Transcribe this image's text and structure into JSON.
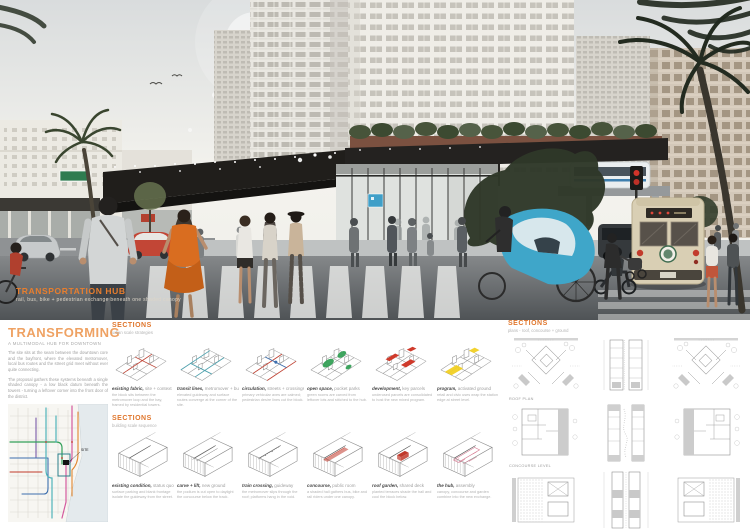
{
  "hero": {
    "title": "TRANSPORTATION HUB",
    "subtitle": "rail, bus, bike + pedestrian exchange beneath one shaded canopy"
  },
  "left": {
    "title": "TRANSFORMING",
    "subtitle": "A MULTIMODAL HUB FOR DOWNTOWN",
    "para1": "The site sits at the seam between the downtown core and the bayfront, where the elevated metromover, local bus routes and the street grid meet without ever quite connecting.",
    "para2": "The proposal gathers these systems beneath a single shaded canopy - a low black datum beneath the towers - turning a leftover corner into the front door of the district.",
    "map_site_label": "SITE",
    "map_caption": "Existing transit network: colored lines trace metromover, trolley and bus routes. The black marker locates the proposed hub at their crossing."
  },
  "middle": {
    "row1": {
      "header": "SECTIONS",
      "subheader": "urban scale strategies",
      "items": [
        {
          "lead": "existing fabric,",
          "tail": "site + context",
          "accent": "#c44536",
          "variant": "v1",
          "desc": "the block sits between the metromover loop and the bay, framed by residential towers."
        },
        {
          "lead": "transit lines,",
          "tail": "metromover + bus",
          "accent": "#4fa3b0",
          "variant": "v2",
          "desc": "elevated guideway and surface routes converge at the corner of the site."
        },
        {
          "lead": "circulation,",
          "tail": "streets + crossings",
          "accent": "#c44536",
          "variant": "v3",
          "desc": "primary vehicular axes are calmed; pedestrian desire lines cut the block."
        },
        {
          "lead": "open space,",
          "tail": "pocket parks",
          "accent": "#2f9e52",
          "variant": "v4",
          "desc": "green rooms are carved from leftover lots and stitched to the hub."
        },
        {
          "lead": "development,",
          "tail": "key parcels",
          "accent": "#cf3a2b",
          "variant": "v5",
          "desc": "underused parcels are consolidated to host the new mixed program."
        },
        {
          "lead": "program,",
          "tail": "activated ground",
          "accent": "#f2d024",
          "variant": "v6",
          "desc": "retail and civic uses wrap the station edge at street level."
        }
      ]
    },
    "row2": {
      "header": "SECTIONS",
      "subheader": "building scale sequence",
      "items": [
        {
          "lead": "existing condition,",
          "tail": "status quo",
          "accent": "#8a8a8a",
          "variant": "b1",
          "desc": "surface parking and blank frontage isolate the guideway from the street."
        },
        {
          "lead": "carve + lift,",
          "tail": "new ground",
          "accent": "#8a8a8a",
          "variant": "b2",
          "desc": "the podium is cut open to daylight the concourse below the track."
        },
        {
          "lead": "train crossing,",
          "tail": "guideway",
          "accent": "#8a8a8a",
          "variant": "b3",
          "desc": "the metromover slips through the roof; platforms hang in the void."
        },
        {
          "lead": "concourse,",
          "tail": "public room",
          "accent": "#c0392b",
          "variant": "b4",
          "desc": "a shaded hall gathers bus, bike and rail riders under one canopy."
        },
        {
          "lead": "roof garden,",
          "tail": "shared deck",
          "accent": "#c0392b",
          "variant": "b5",
          "desc": "planted terraces shade the hall and cool the block below."
        },
        {
          "lead": "the hub,",
          "tail": "assembly",
          "accent": "#d4738c",
          "variant": "b6",
          "desc": "canopy, concourse and garden combine into the new exchange."
        }
      ]
    }
  },
  "right": {
    "header": "SECTIONS",
    "subheader": "plans - roof, concourse + ground",
    "rows": [
      {
        "label": "ROOF PLAN",
        "cells": [
          "clusterA",
          "twinTall",
          "clusterA-m"
        ]
      },
      {
        "label": "CONCOURSE LEVEL",
        "cells": [
          "courtA",
          "twinDots",
          "courtA-m"
        ]
      },
      {
        "label": "GROUND LEVEL",
        "cells": [
          "hatchA",
          "stationB",
          "hatchA-m"
        ]
      }
    ]
  },
  "colors": {
    "accent_orange": "#e0762c",
    "hub_canopy_black": "#201e1b",
    "pedicab_blue": "#3fa6c9",
    "trolley_cream": "#d9cfb4"
  }
}
